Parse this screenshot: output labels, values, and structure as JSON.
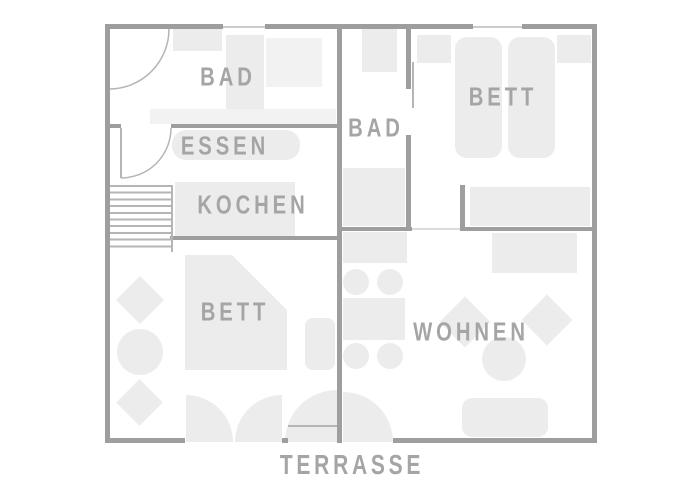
{
  "plan": {
    "rooms": {
      "bad_left": {
        "label": "BAD"
      },
      "essen": {
        "label": "ESSEN"
      },
      "kochen": {
        "label": "KOCHEN"
      },
      "bett_left": {
        "label": "BETT"
      },
      "bad_right": {
        "label": "BAD"
      },
      "bett_right": {
        "label": "BETT"
      },
      "wohnen": {
        "label": "WOHNEN"
      }
    },
    "outside": {
      "terrasse_label": "TERRASSE"
    },
    "colors": {
      "background": "#ffffff",
      "wall": "#9e9e9e",
      "furniture": "#ececec",
      "furniture_light": "#f2f2f2",
      "line": "#b5b5b5",
      "window": "#cccccc",
      "label": "#a5a5a5"
    }
  }
}
